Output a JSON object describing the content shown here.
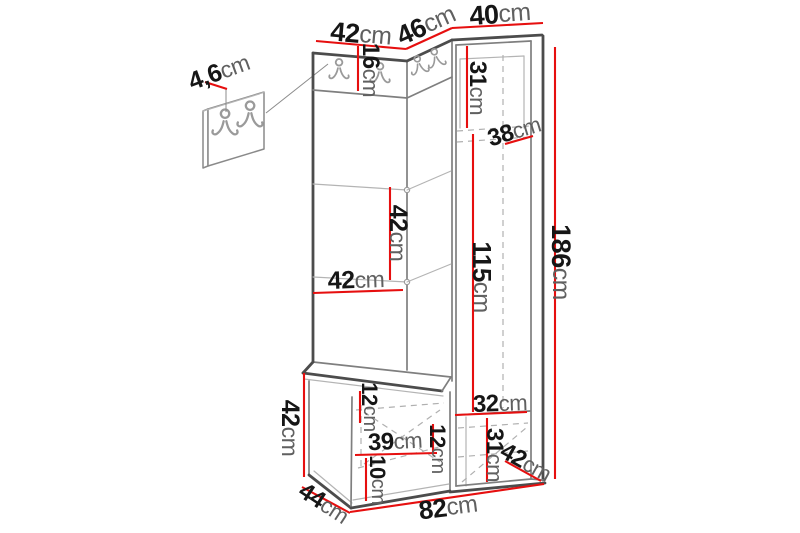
{
  "diagram": {
    "type": "furniture-dimension-diagram",
    "subject": "hallway wardrobe set with coat hooks and bench",
    "unit": "cm"
  },
  "colors": {
    "dimension_red": "#e60f0f",
    "outline_dark": "#4c4c4c",
    "outline_mid": "#7f7f7f",
    "outline_light": "#b4b4b4",
    "label_number": "#161616",
    "label_unit": "#606060",
    "background": "#ffffff"
  },
  "icons": {
    "coat_hook": "coat-hook"
  },
  "dims": {
    "top_width_left": {
      "value": "42",
      "unit": "cm"
    },
    "top_width_middle": {
      "value": "46",
      "unit": "cm"
    },
    "top_width_right": {
      "value": "40",
      "unit": "cm"
    },
    "wall_panel_depth": {
      "value": "4,6",
      "unit": "cm"
    },
    "hook_strip_height": {
      "value": "16",
      "unit": "cm"
    },
    "niche_top_height": {
      "value": "31",
      "unit": "cm"
    },
    "niche_depth": {
      "value": "38",
      "unit": "cm"
    },
    "shelf_spacing": {
      "value": "42",
      "unit": "cm"
    },
    "panel_width": {
      "value": "42",
      "unit": "cm"
    },
    "inner_height": {
      "value": "115",
      "unit": "cm"
    },
    "total_height": {
      "value": "186",
      "unit": "cm"
    },
    "bench_height": {
      "value": "42",
      "unit": "cm"
    },
    "seat_height": {
      "value": "12",
      "unit": "cm"
    },
    "bench_inner_width": {
      "value": "39",
      "unit": "cm"
    },
    "bench_inner_height": {
      "value": "12",
      "unit": "cm"
    },
    "plinth_height": {
      "value": "10",
      "unit": "cm"
    },
    "lower_shelf_width": {
      "value": "32",
      "unit": "cm"
    },
    "lower_shelf_height": {
      "value": "31",
      "unit": "cm"
    },
    "side_depth": {
      "value": "42",
      "unit": "cm"
    },
    "bench_depth": {
      "value": "44",
      "unit": "cm"
    },
    "total_width": {
      "value": "82",
      "unit": "cm"
    }
  }
}
